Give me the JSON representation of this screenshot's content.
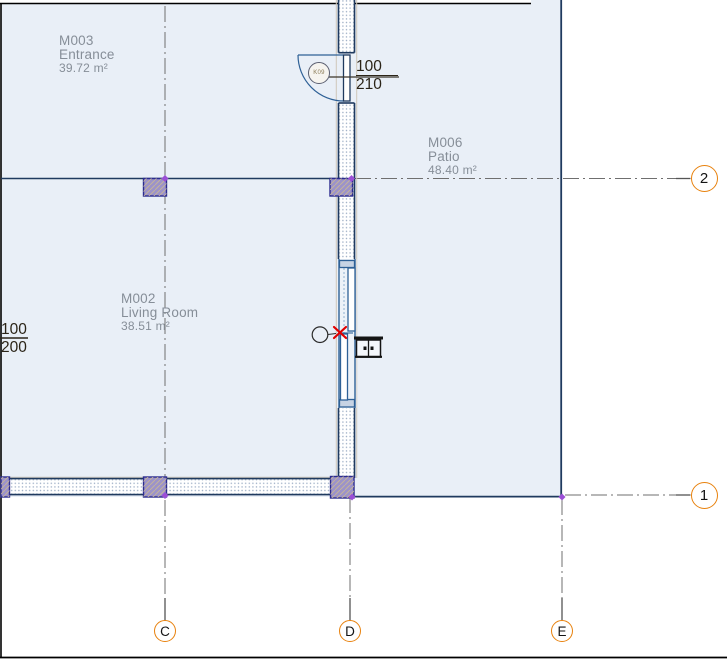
{
  "rooms": [
    {
      "id": "M003",
      "name": "Entrance",
      "area": "39.72 m²"
    },
    {
      "id": "M006",
      "name": "Patio",
      "area": "48.40 m²"
    },
    {
      "id": "M002",
      "name": "Living Room",
      "area": "38.51 m²"
    }
  ],
  "tags": {
    "door": {
      "label": "K09",
      "width": "100",
      "height": "210"
    },
    "window": {
      "width": "100",
      "height": "200"
    }
  },
  "grids": {
    "rows": [
      {
        "label": "2"
      },
      {
        "label": "1"
      }
    ],
    "cols": [
      {
        "label": "C"
      },
      {
        "label": "D"
      },
      {
        "label": "E"
      }
    ]
  },
  "colors": {
    "plan_background": "#e9eff7",
    "wall_edge": "#1f3a5f",
    "fixture_blue": "#2e6096",
    "column_fill": "#9c93c9",
    "grid_bubble_ring": "#e8820e",
    "grid_line": "#6f6f6f",
    "room_label_text": "#868e98",
    "dimension_text": "#2b2418",
    "flip_control": "#e10000",
    "node_marker": "#9b4fd6"
  }
}
